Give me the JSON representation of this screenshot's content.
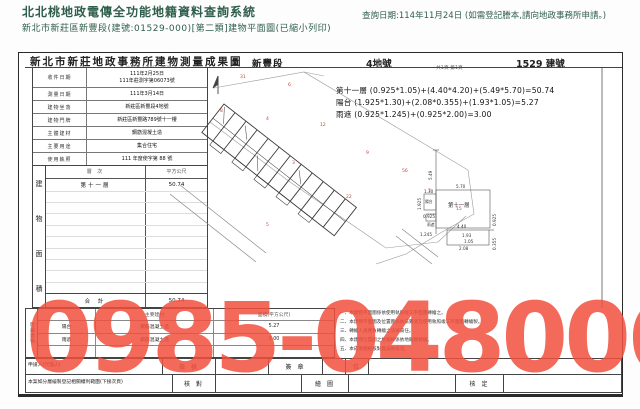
{
  "colors": {
    "accent_text": "#2f5f4c",
    "watermark_red": "#f2503e"
  },
  "header": {
    "system_title": "北北桃地政電傳全功能地籍資料查詢系統",
    "document_line": "新北市新莊區新豐段(建號:01529-000)[第二類]建物平面圖(已縮小列印)",
    "query_date": "查詢日期:114年11月24日 (如需登記謄本,請向地政事務所申請。)"
  },
  "sheet": {
    "title": "新北市新莊地政事務所建物測量成果圖",
    "section_name": "新豐段",
    "land_number": "4地號",
    "building_number": "1529 建號",
    "scale_note": "比例尺 1/300 1/600",
    "page_note": "共1頁 第1頁",
    "info_table": {
      "rows": [
        {
          "label": "收件日期",
          "value": "111年2月25日",
          "value2": "111年莊測字第06073號"
        },
        {
          "label": "測量日期",
          "value": "111年3月14日",
          "value2": ""
        },
        {
          "label": "建物坐落",
          "value": "新莊區新豐段4地號",
          "value2": ""
        },
        {
          "label": "建物門牌",
          "value": "新莊區新豐路789號十一樓",
          "value2": ""
        },
        {
          "label": "主體建材",
          "value": "鋼筋混凝土造",
          "value2": ""
        },
        {
          "label": "主要用途",
          "value": "集合住宅",
          "value2": ""
        },
        {
          "label": "使用執照",
          "value": "111 年度使字第 88 號",
          "value2": ""
        }
      ]
    },
    "area_table": {
      "side_label_chars": [
        "建",
        "物",
        "面",
        "積"
      ],
      "col_level": "層 次",
      "col_sqm": "平方公尺",
      "level_1": "第十一層",
      "area_1": "50.74",
      "total_label": "合 計",
      "total_value": "50.74"
    },
    "formulas": {
      "line1": "第十一層 (0.925*1.05)+(4.40*4.20)+(5.49*5.70)=50.74",
      "line2": "陽台 (1.925*1.30)+(2.08*0.355)+(1.93*1.05)=5.27",
      "line3": "雨遮 (0.925*1.245)+(0.925*2.00)=3.00"
    },
    "detail": {
      "dim_549": "5.49",
      "dim_570": "5.70",
      "unit_label": "第十一層",
      "dim_130": "1.30",
      "balcony_label": "陽台",
      "dim_1925": "1.925",
      "dim_0925a": "0.925",
      "canopy_label": "雨遮",
      "dim_1245": "1.245",
      "dim_440": "4.40",
      "dim_0925b": "0.925",
      "dim_193": "1.93",
      "dim_105": "1.05",
      "dim_208": "2.08",
      "dim_0355": "0.355"
    },
    "annex_table": {
      "side_label": "附屬建物",
      "col_material": "主要建材",
      "col_area": "面積(平方公尺)",
      "rows": [
        {
          "name": "陽台",
          "material": "鋼筋混凝土造",
          "area": "5.27"
        },
        {
          "name": "雨遮",
          "material": "鋼筋混凝土造",
          "area": "3.00"
        }
      ]
    },
    "notes": {
      "n1": "一、本建物平面圖係依使用執照竣工平面圖轉繪之。",
      "n2": "二、本建物平面圖及位置圖係依法實測及使用執照竣工平面圖轉繪製。",
      "n3": "三、轉繪人員應負轉繪之法律責任。",
      "n4": "四、本建物位置圖之地籍線係依地籍圖轉繪。",
      "n5": "五、本成果圖經核對無誤後核發。"
    },
    "sign_rows": {
      "applicant_label": "申請人(代理人)",
      "check_label": "檢 核",
      "sign_label": "簽 章",
      "unit_label": "位",
      "case_note": "本案如分層繪製登記相關權利範圍(下接次頁)",
      "verify_label": "核 對",
      "draw_label": "繪 圖",
      "approve_label": "核 定"
    }
  },
  "map": {
    "marks": [
      "31",
      "6",
      "8",
      "4",
      "12",
      "9",
      "56",
      "7",
      "15",
      "3",
      "22",
      "5"
    ]
  },
  "watermark": {
    "text": "0985-048006"
  }
}
